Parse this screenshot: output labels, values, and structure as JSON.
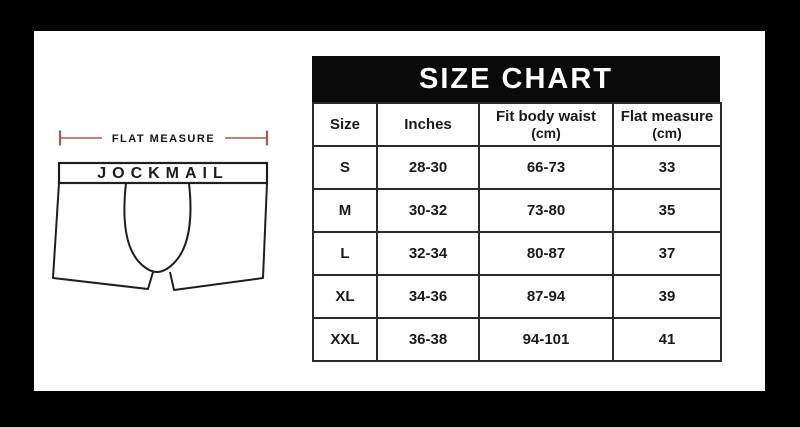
{
  "frame": {
    "bg": "#000000",
    "canvas_bg": "#ffffff"
  },
  "diagram": {
    "measure_label": "FLAT MEASURE",
    "brand": "JOCKMAIL",
    "dimension_line_color": "#a85c58",
    "drawing_line_color": "#1f1f1f"
  },
  "size_chart": {
    "title": "SIZE CHART",
    "banner_bg": "#0a0a0a",
    "banner_text_color": "#ffffff",
    "columns": [
      {
        "label": "Size",
        "sub": ""
      },
      {
        "label": "Inches",
        "sub": ""
      },
      {
        "label": "Fit body waist",
        "sub": "(cm)"
      },
      {
        "label": "Flat measure",
        "sub": "(cm)"
      }
    ],
    "rows": [
      {
        "size": "S",
        "inches": "28-30",
        "fit_body_waist": "66-73",
        "flat_measure": "33"
      },
      {
        "size": "M",
        "inches": "30-32",
        "fit_body_waist": "73-80",
        "flat_measure": "35"
      },
      {
        "size": "L",
        "inches": "32-34",
        "fit_body_waist": "80-87",
        "flat_measure": "37"
      },
      {
        "size": "XL",
        "inches": "34-36",
        "fit_body_waist": "87-94",
        "flat_measure": "39"
      },
      {
        "size": "XXL",
        "inches": "36-38",
        "fit_body_waist": "94-101",
        "flat_measure": "41"
      }
    ]
  },
  "chart_data": {
    "type": "table",
    "title": "SIZE CHART",
    "columns": [
      "Size",
      "Inches",
      "Fit body waist (cm)",
      "Flat measure (cm)"
    ],
    "rows": [
      [
        "S",
        "28-30",
        "66-73",
        "33"
      ],
      [
        "M",
        "30-32",
        "73-80",
        "35"
      ],
      [
        "L",
        "32-34",
        "80-87",
        "37"
      ],
      [
        "XL",
        "34-36",
        "87-94",
        "39"
      ],
      [
        "XXL",
        "36-38",
        "94-101",
        "41"
      ]
    ]
  }
}
